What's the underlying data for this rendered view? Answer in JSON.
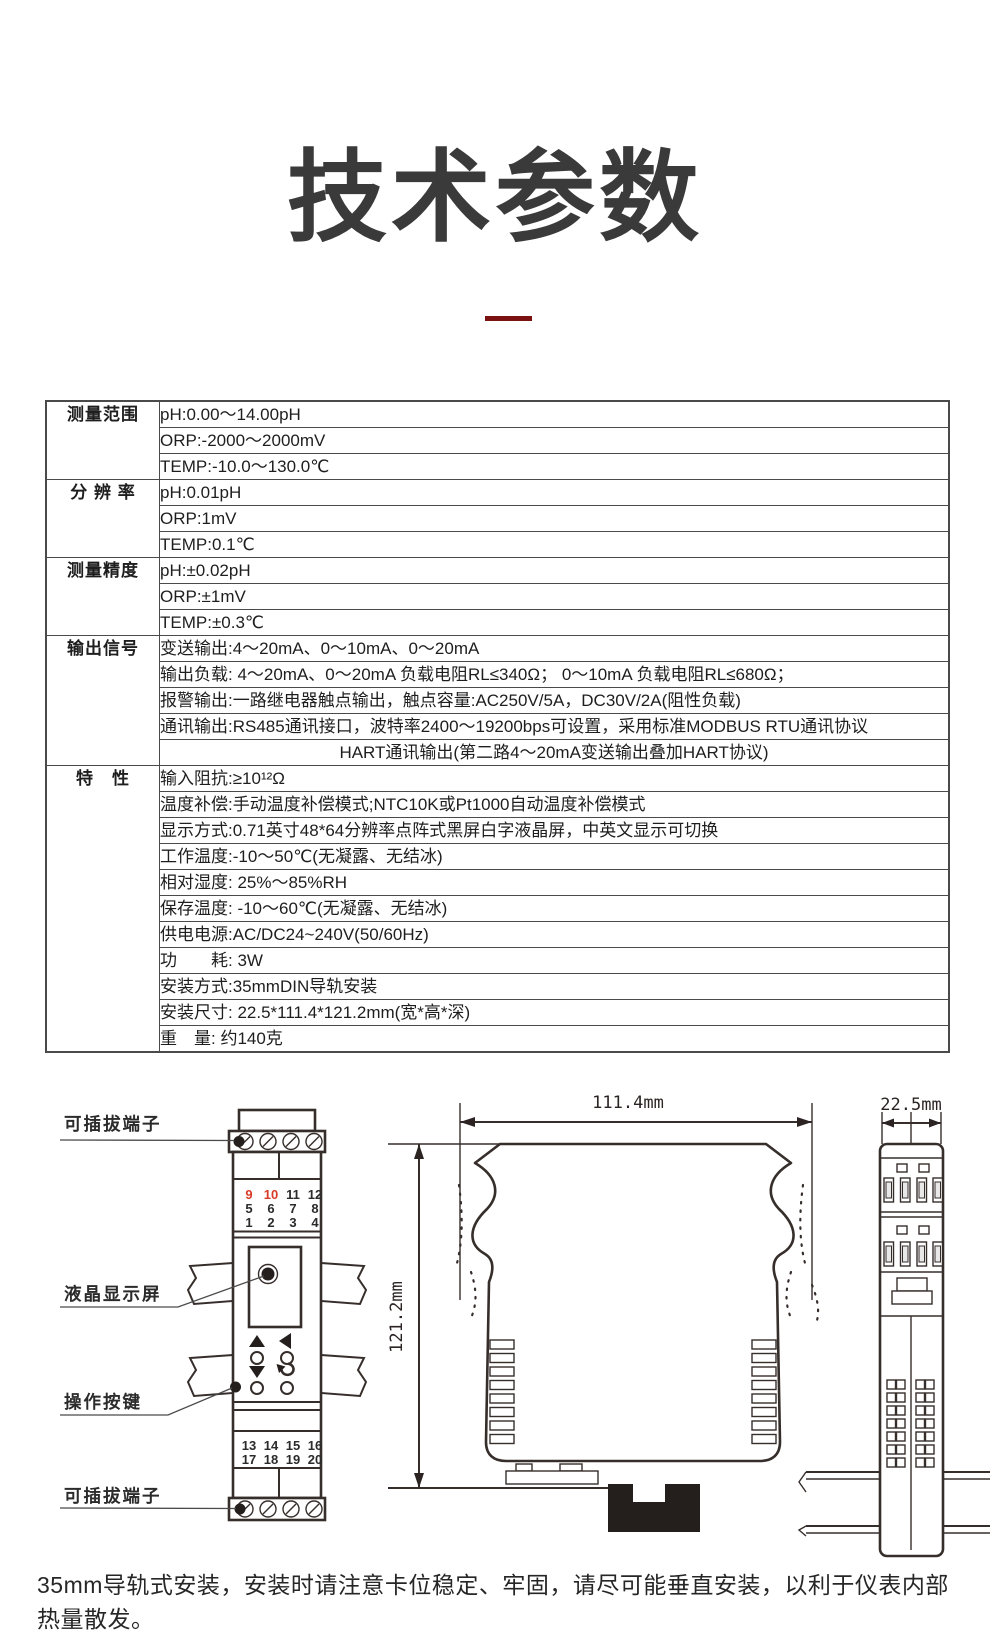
{
  "page": {
    "title": "技术参数"
  },
  "colors": {
    "title_text": "#3a3a3a",
    "accent_dash": "#7a1212",
    "table_border": "#4a4a4a",
    "terminal_red": "#d83c28",
    "drawing_stroke": "#362e2b"
  },
  "spec_table": {
    "groups": [
      {
        "label": "测量范围",
        "rows": [
          {
            "text": "pH:0.00～14.00pH"
          },
          {
            "text": "ORP:-2000～2000mV"
          },
          {
            "text": "TEMP:-10.0～130.0℃"
          }
        ]
      },
      {
        "label": "分 辨 率",
        "rows": [
          {
            "text": "pH:0.01pH"
          },
          {
            "text": "ORP:1mV"
          },
          {
            "text": "TEMP:0.1℃"
          }
        ]
      },
      {
        "label": "测量精度",
        "rows": [
          {
            "text": "pH:±0.02pH"
          },
          {
            "text": "ORP:±1mV"
          },
          {
            "text": "TEMP:±0.3℃"
          }
        ]
      },
      {
        "label": "输出信号",
        "rows": [
          {
            "text": "变送输出:4～20mA、0～10mA、0～20mA"
          },
          {
            "text": "输出负载: 4～20mA、0～20mA 负载电阻RL≤340Ω； 0～10mA 负载电阻RL≤680Ω；"
          },
          {
            "text": "报警输出:一路继电器触点输出，触点容量:AC250V/5A，DC30V/2A(阻性负载)"
          },
          {
            "text": "通讯输出:RS485通讯接口，波特率2400～19200bps可设置，采用标准MODBUS RTU通讯协议"
          },
          {
            "text": "HART通讯输出(第二路4～20mA变送输出叠加HART协议)",
            "align": "center"
          }
        ]
      },
      {
        "label": "特　性",
        "rows": [
          {
            "text": "输入阻抗:≥10¹²Ω"
          },
          {
            "text": "温度补偿:手动温度补偿模式;NTC10K或Pt1000自动温度补偿模式"
          },
          {
            "text": "显示方式:0.71英寸48*64分辨率点阵式黑屏白字液晶屏，中英文显示可切换"
          },
          {
            "text": "工作温度:-10～50℃(无凝露、无结冰)"
          },
          {
            "text": "相对湿度: 25%～85%RH"
          },
          {
            "text": "保存温度: -10～60℃(无凝露、无结冰)"
          },
          {
            "text": "供电电源:AC/DC24~240V(50/60Hz)"
          },
          {
            "text": "功　　耗: 3W"
          },
          {
            "text": "安装方式:35mmDIN导轨安装"
          },
          {
            "text": "安装尺寸: 22.5*111.4*121.2mm(宽*高*深)"
          },
          {
            "text": "重　量: 约140克"
          }
        ]
      }
    ]
  },
  "drawings": {
    "front_view": {
      "label_top_terminal": "可插拔端子",
      "label_lcd": "液晶显示屏",
      "label_buttons": "操作按键",
      "label_bottom_terminal": "可插拔端子",
      "terminal_rows_top": [
        [
          "9",
          "10",
          "11",
          "12"
        ],
        [
          "5",
          "6",
          "7",
          "8"
        ],
        [
          "1",
          "2",
          "3",
          "4"
        ]
      ],
      "terminal_rows_bottom": [
        [
          "13",
          "14",
          "15",
          "16"
        ],
        [
          "17",
          "18",
          "19",
          "20"
        ]
      ]
    },
    "side_view": {
      "width_dim": "111.4mm",
      "depth_dim": "121.2mm"
    },
    "end_view": {
      "width_dim": "22.5mm"
    }
  },
  "footer": {
    "note": "35mm导轨式安装，安装时请注意卡位稳定、牢固，请尽可能垂直安装，以利于仪表内部热量散发。"
  }
}
